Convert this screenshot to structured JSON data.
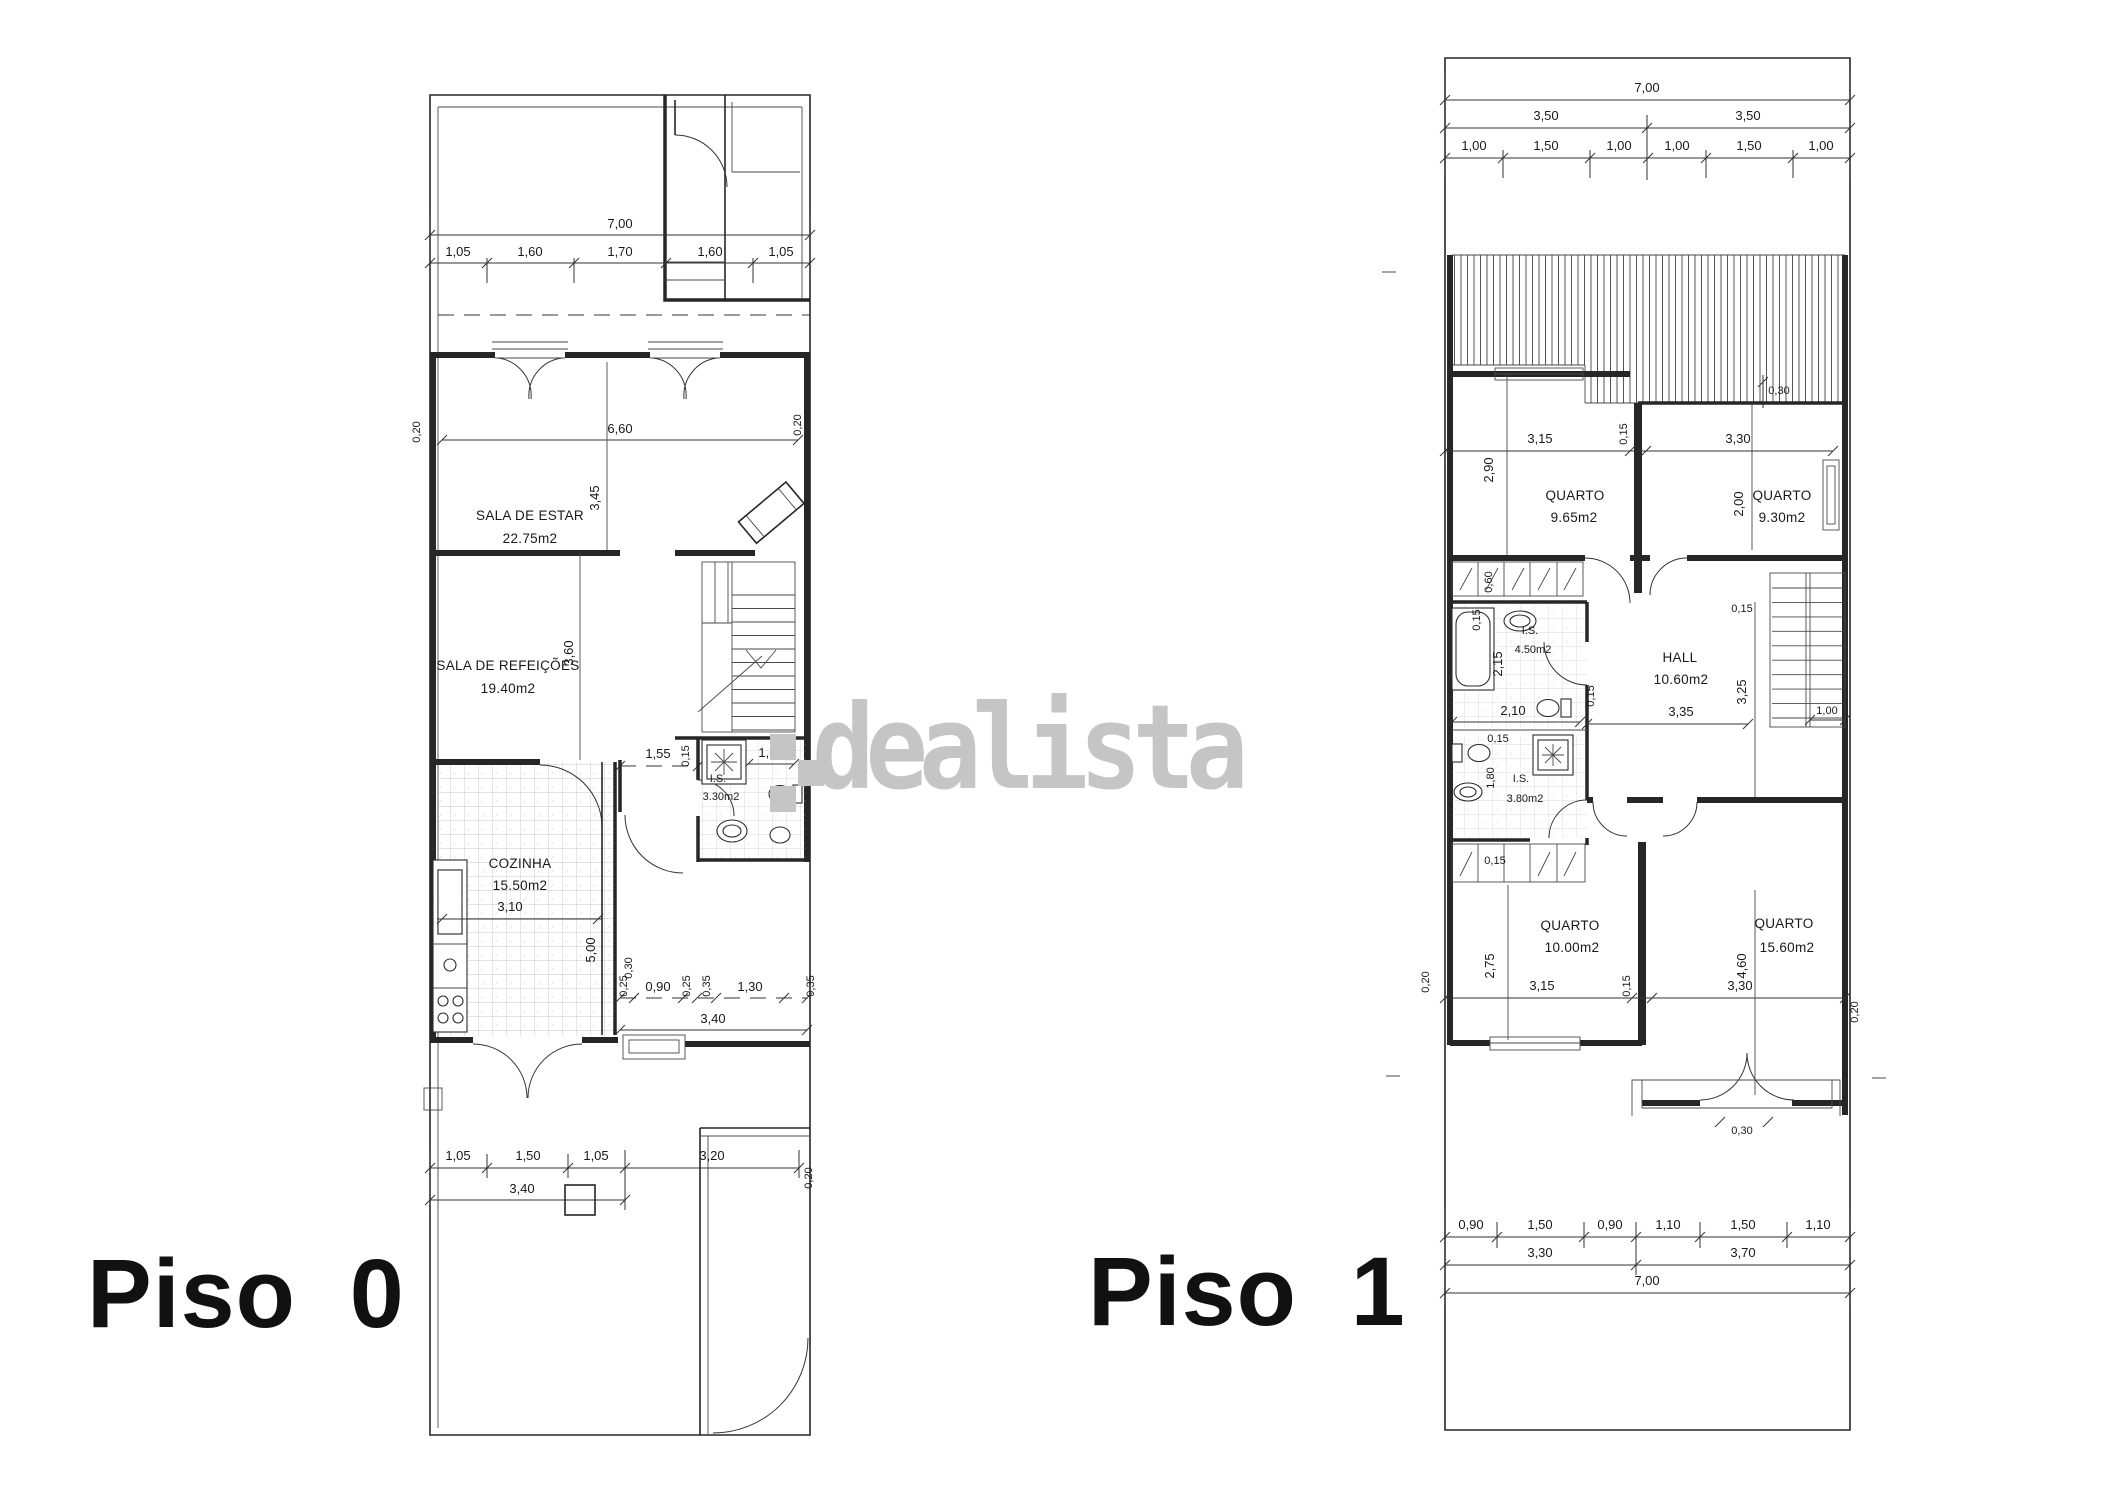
{
  "watermark": {
    "text": "dealista",
    "color": "#c5c5c5"
  },
  "floor0": {
    "label": "Piso 0",
    "rooms": {
      "living": {
        "name": "SALA DE ESTAR",
        "area": "22.75m2"
      },
      "dining": {
        "name": "SALA DE REFEIÇÕES",
        "area": "19.40m2"
      },
      "kitchen": {
        "name": "COZINHA",
        "area": "15.50m2"
      },
      "wc": {
        "name": "I.S.",
        "area": "3.30m2"
      }
    },
    "dims": {
      "total_width": "7,00",
      "top": [
        "1,05",
        "1,60",
        "1,70",
        "1,60",
        "1,05"
      ],
      "living_width": "6,60",
      "living_depth": "3,45",
      "wall_left": "0,20",
      "wall_right": "0,20",
      "dining_depth": "3,60",
      "hall_width": "1,55",
      "wall_thin": "0,15",
      "wc_width": "1,65",
      "kitchen_width": "3,10",
      "kitchen_depth": "5,00",
      "step": "0,30",
      "rear": [
        "0,25",
        "0,90",
        "0,25",
        "0,35",
        "1,30",
        "0,35"
      ],
      "rear_total": "3,40",
      "bottom": [
        "1,05",
        "1,50",
        "1,05"
      ],
      "bottom_left_total": "3,40",
      "terrace_width": "3,20",
      "bottom_wall": "0,20"
    }
  },
  "floor1": {
    "label": "Piso 1",
    "rooms": {
      "bed1": {
        "name": "QUARTO",
        "area": "9.65m2"
      },
      "bed2": {
        "name": "QUARTO",
        "area": "9.30m2"
      },
      "hall": {
        "name": "HALL",
        "area": "10.60m2"
      },
      "wc1": {
        "name": "I.S.",
        "area": "4.50m2"
      },
      "wc2": {
        "name": "I.S.",
        "area": "3.80m2"
      },
      "bed3": {
        "name": "QUARTO",
        "area": "10.00m2"
      },
      "bed4": {
        "name": "QUARTO",
        "area": "15.60m2"
      }
    },
    "dims": {
      "total_width_top": "7,00",
      "halves": [
        "3,50",
        "3,50"
      ],
      "top": [
        "1,00",
        "1,50",
        "1,00",
        "1,00",
        "1,50",
        "1,00"
      ],
      "roof_offset": "0,30",
      "bed1_width": "3,15",
      "wall_thin": "0,15",
      "bed2_width": "3,30",
      "bed1_depth": "2,90",
      "bed2_depth": "2,00",
      "wardrobe": "0,60",
      "wc1_depth": "2,15",
      "wc1_width": "2,10",
      "hall_width": "3,35",
      "hall_depth": "3,25",
      "stair_width": "1,00",
      "wc2_depth": "1,80",
      "bed3_depth": "2,75",
      "bed3_width": "3,15",
      "bed4_depth": "4,60",
      "bed4_width": "3,30",
      "wall_left": "0,20",
      "wall_right": "0,20",
      "porch": "0,30",
      "bottom": [
        "0,90",
        "1,50",
        "0,90",
        "1,10",
        "1,50",
        "1,10"
      ],
      "bottom_halves": [
        "3,30",
        "3,70"
      ],
      "total_width_bottom": "7,00"
    }
  }
}
